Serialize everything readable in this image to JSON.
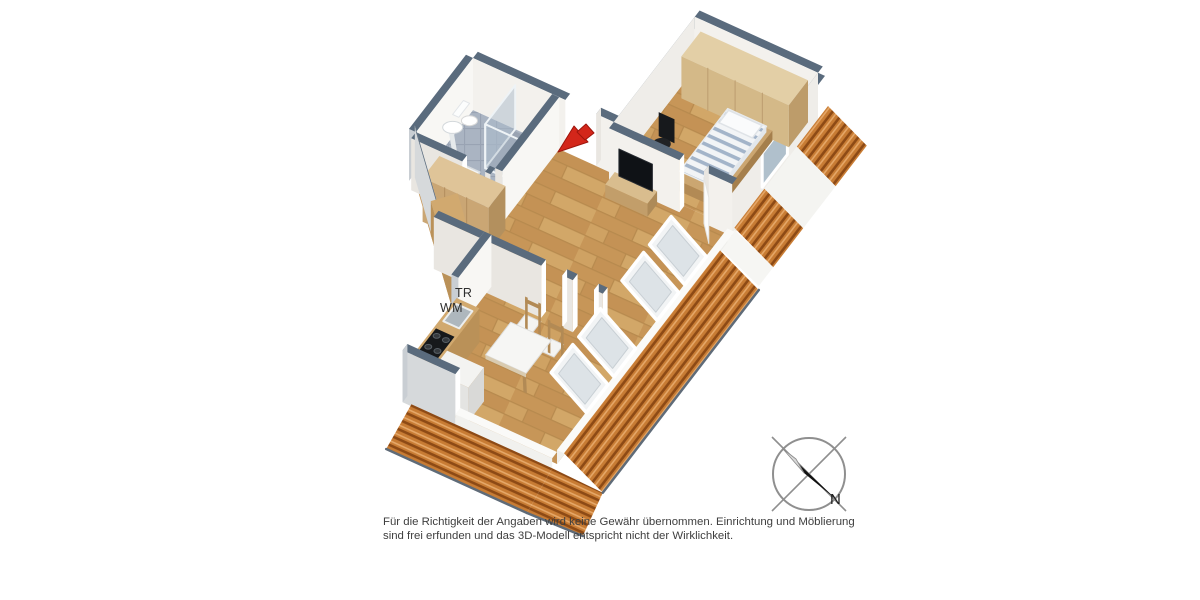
{
  "floorplan": {
    "appliance_labels": {
      "dryer": "TR",
      "washing_machine": "WM"
    },
    "compass": {
      "north_label": "N"
    },
    "disclaimer": {
      "line1": "Für die Richtigkeit der Angaben wird keine Gewähr übernommen. Einrichtung und Möblierung",
      "line2": "sind frei erfunden und das 3D-Modell entspricht nicht der Wirklichkeit."
    },
    "colors": {
      "wall_top": "#5a6b7d",
      "wall_face": "#f3f1ed",
      "wall_face_shade": "#e9e6e1",
      "wall_face_light": "#f8f7f4",
      "wall_face_w": "#efede9",
      "wall_outer": "#c9ced3",
      "wall_outer2": "#d6d9db",
      "floor_wood": "#cb9d62",
      "floor_wood_dark": "#b78a4e",
      "bath_tile": "#aab4c2",
      "bath_tile_line": "#99a3b3",
      "roof_tile": "#c87c34",
      "roof_tile_dark": "#8d4a15",
      "roof_tile_light": "#e5a768",
      "glass": "#a9bac9",
      "arrow_red": "#d3261a",
      "compass_line": "#8f8f8f",
      "text": "#2e2e2e"
    }
  }
}
